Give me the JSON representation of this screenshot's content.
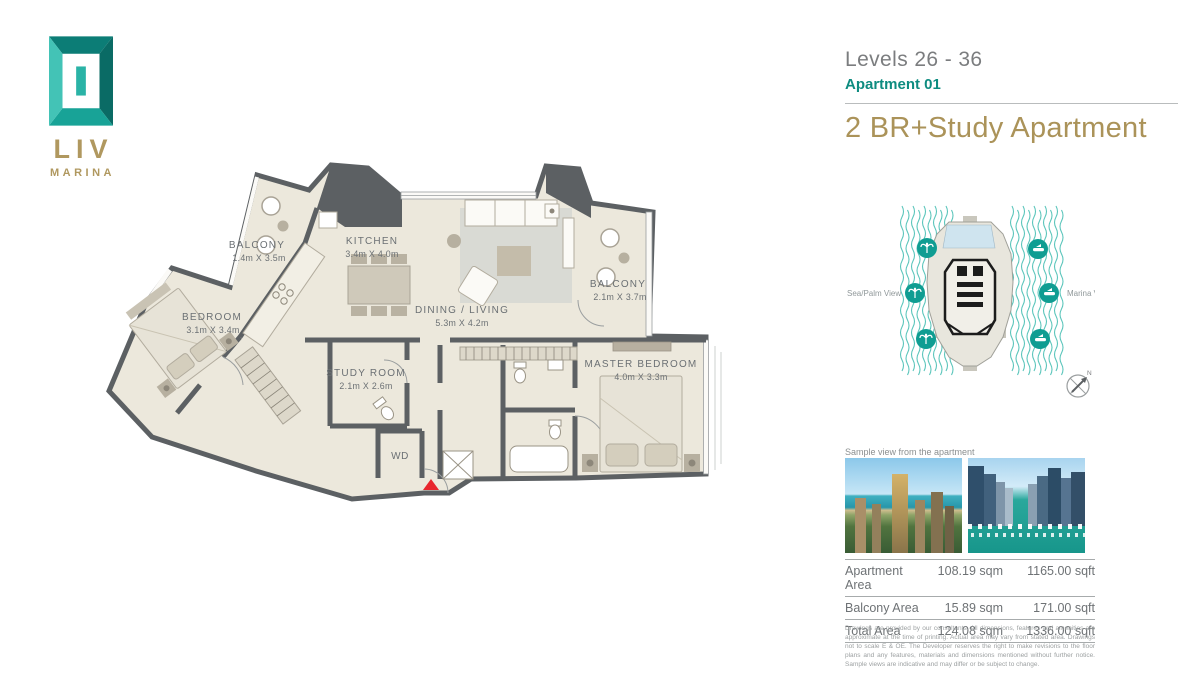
{
  "brand": {
    "logo_text": "LIV",
    "logo_sub": "MARINA"
  },
  "header": {
    "levels": "Levels 26 - 36",
    "apartment": "Apartment 01",
    "title": "2 BR+Study Apartment"
  },
  "floorplan": {
    "entrance_marker_color": "#e8262d",
    "rooms": {
      "balcony_left": {
        "name": "BALCONY",
        "dims": "1.4m X 3.5m"
      },
      "kitchen": {
        "name": "KITCHEN",
        "dims": "3.4m X 4.0m"
      },
      "dining_living": {
        "name": "DINING / LIVING",
        "dims": "5.3m X 4.2m"
      },
      "balcony_right": {
        "name": "BALCONY",
        "dims": "2.1m X 3.7m"
      },
      "bedroom": {
        "name": "BEDROOM",
        "dims": "3.1m X 3.4m"
      },
      "study": {
        "name": "STUDY ROOM",
        "dims": "2.1m X 2.6m"
      },
      "master": {
        "name": "MASTER BEDROOM",
        "dims": "4.0m X 3.3m"
      },
      "wd": {
        "name": "WD"
      }
    }
  },
  "orientation": {
    "left_label": "Sea/Palm View",
    "right_label": "Marina View",
    "compass_label": "N"
  },
  "views": {
    "caption": "Sample view from the apartment"
  },
  "area_table": {
    "rows": [
      {
        "label": "Apartment Area",
        "sqm": "108.19 sqm",
        "sqft": "1165.00 sqft"
      },
      {
        "label": "Balcony Area",
        "sqm": "15.89 sqm",
        "sqft": "171.00 sqft"
      },
      {
        "label": "Total Area",
        "sqm": "124.08 sqm",
        "sqft": "1336.00 sqft"
      }
    ]
  },
  "disclaimer": "Drawings are provided by our consultants. All dimensions, features and amenities are approximate at the time of printing. Actual area may vary from stated area. Drawings not to scale E & OE. The Developer reserves the right to make revisions to the floor plans and any features, materials and dimensions mentioned without further notice. Sample views are indicative and may differ or be subject to change.",
  "colors": {
    "teal": "#149a8e",
    "gold": "#b0985f",
    "wall": "#5c6063",
    "floor": "#ece8dc",
    "highlight": "#cfe4ef"
  }
}
